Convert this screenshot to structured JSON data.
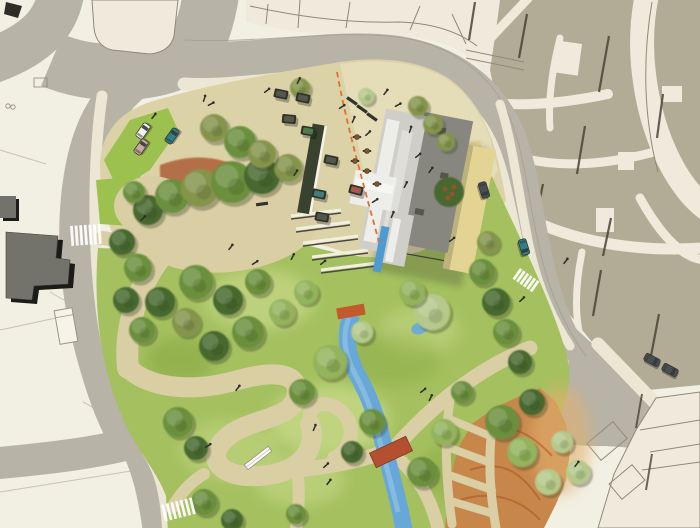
{
  "palette": {
    "background": "#f2efe3",
    "parcel_line": "#c9c3b0",
    "block": "#b2ab96",
    "block_edge": "#4a4436",
    "block_line": "#8f897a",
    "street_cream": "#efeadb",
    "road": "#b7b3a6",
    "road_edge": "#a09c8e",
    "sidewalk": "#ece7d4",
    "plaza": "#dcd2a8",
    "plaza_light": "#e6debb",
    "courtyard": "#e3d494",
    "lawn": "#a4c05f",
    "lawn_bright": "#9dc14e",
    "lawn_light": "#c7d987",
    "lawn_dark": "#84a43c",
    "path": "#d9cea4",
    "mulch": "#ad6038",
    "slope": "#c8874a",
    "slope_streak": "#a85a28",
    "slope_light": "#e2b070",
    "water": "#68a8d8",
    "water_light": "#93c3e6",
    "pool": "#4e9bd2",
    "bridge": "#b4502f",
    "fountain": "#c35a2c",
    "dashed_line": "#e0702c",
    "roof_light": "#cfcec8",
    "roof_white": "#ededea",
    "roof_mid": "#dfdeda",
    "wing_dark": "#87877f",
    "roof_detail": "#55554e",
    "strip_dark": "#39422e",
    "strip_edge": "#f5f3ea",
    "bench_body": "#2f332a",
    "bench_top_dark": "#54584a",
    "bench_green": "#4c7c4a",
    "bench_red": "#b2544a",
    "bench_teal": "#3f7e7b",
    "car_white": "#f2f2ee",
    "car_teal": "#2e7f86",
    "car_dark": "#4a4f52",
    "car_pink": "#c9a8a0",
    "people": "#2f2e28",
    "table_brown": "#7a5632",
    "white_bench": "#fafaf6",
    "dark_building": "#73736c",
    "crosswalk": "#ffffff",
    "tree": {
      "shadow": "#3a4526",
      "dark": "#47682e",
      "mid": "#6b8f3d",
      "olive": "#85944c",
      "light": "#93b35c",
      "pale": "#b5c98b"
    }
  },
  "features": {
    "trees": [
      {
        "x": 148,
        "y": 210,
        "r": 15,
        "tone": "dark"
      },
      {
        "x": 172,
        "y": 196,
        "r": 17,
        "tone": "mid"
      },
      {
        "x": 200,
        "y": 188,
        "r": 19,
        "tone": "olive"
      },
      {
        "x": 232,
        "y": 182,
        "r": 21,
        "tone": "mid"
      },
      {
        "x": 262,
        "y": 176,
        "r": 18,
        "tone": "dark"
      },
      {
        "x": 288,
        "y": 168,
        "r": 14,
        "tone": "olive"
      },
      {
        "x": 214,
        "y": 128,
        "r": 14,
        "tone": "olive"
      },
      {
        "x": 240,
        "y": 142,
        "r": 16,
        "tone": "mid"
      },
      {
        "x": 262,
        "y": 154,
        "r": 14,
        "tone": "olive"
      },
      {
        "x": 122,
        "y": 242,
        "r": 13,
        "tone": "dark"
      },
      {
        "x": 138,
        "y": 268,
        "r": 14,
        "tone": "mid"
      },
      {
        "x": 126,
        "y": 300,
        "r": 13,
        "tone": "dark"
      },
      {
        "x": 142,
        "y": 330,
        "r": 13,
        "tone": "mid"
      },
      {
        "x": 160,
        "y": 302,
        "r": 15,
        "tone": "dark"
      },
      {
        "x": 196,
        "y": 282,
        "r": 17,
        "tone": "mid"
      },
      {
        "x": 228,
        "y": 300,
        "r": 15,
        "tone": "dark"
      },
      {
        "x": 258,
        "y": 282,
        "r": 13,
        "tone": "mid"
      },
      {
        "x": 186,
        "y": 322,
        "r": 14,
        "tone": "olive"
      },
      {
        "x": 214,
        "y": 346,
        "r": 15,
        "tone": "dark"
      },
      {
        "x": 248,
        "y": 332,
        "r": 16,
        "tone": "mid"
      },
      {
        "x": 282,
        "y": 312,
        "r": 13,
        "tone": "light"
      },
      {
        "x": 306,
        "y": 292,
        "r": 12,
        "tone": "light"
      },
      {
        "x": 330,
        "y": 362,
        "r": 17,
        "tone": "light"
      },
      {
        "x": 302,
        "y": 392,
        "r": 13,
        "tone": "mid"
      },
      {
        "x": 362,
        "y": 332,
        "r": 11,
        "tone": "pale"
      },
      {
        "x": 432,
        "y": 312,
        "r": 18,
        "tone": "pale"
      },
      {
        "x": 412,
        "y": 292,
        "r": 13,
        "tone": "light"
      },
      {
        "x": 372,
        "y": 422,
        "r": 13,
        "tone": "mid"
      },
      {
        "x": 352,
        "y": 452,
        "r": 11,
        "tone": "dark"
      },
      {
        "x": 422,
        "y": 472,
        "r": 15,
        "tone": "mid"
      },
      {
        "x": 444,
        "y": 432,
        "r": 13,
        "tone": "light"
      },
      {
        "x": 462,
        "y": 392,
        "r": 11,
        "tone": "mid"
      },
      {
        "x": 482,
        "y": 272,
        "r": 13,
        "tone": "mid"
      },
      {
        "x": 496,
        "y": 302,
        "r": 14,
        "tone": "dark"
      },
      {
        "x": 506,
        "y": 332,
        "r": 13,
        "tone": "mid"
      },
      {
        "x": 520,
        "y": 362,
        "r": 12,
        "tone": "dark"
      },
      {
        "x": 488,
        "y": 242,
        "r": 11,
        "tone": "olive"
      },
      {
        "x": 502,
        "y": 422,
        "r": 17,
        "tone": "mid"
      },
      {
        "x": 522,
        "y": 452,
        "r": 15,
        "tone": "light"
      },
      {
        "x": 548,
        "y": 482,
        "r": 13,
        "tone": "pale"
      },
      {
        "x": 562,
        "y": 442,
        "r": 11,
        "tone": "pale"
      },
      {
        "x": 578,
        "y": 472,
        "r": 12,
        "tone": "pale"
      },
      {
        "x": 532,
        "y": 402,
        "r": 13,
        "tone": "dark"
      },
      {
        "x": 178,
        "y": 422,
        "r": 15,
        "tone": "mid"
      },
      {
        "x": 196,
        "y": 448,
        "r": 12,
        "tone": "dark"
      },
      {
        "x": 204,
        "y": 502,
        "r": 13,
        "tone": "mid"
      },
      {
        "x": 232,
        "y": 520,
        "r": 11,
        "tone": "dark"
      },
      {
        "x": 296,
        "y": 514,
        "r": 10,
        "tone": "mid"
      },
      {
        "x": 300,
        "y": 88,
        "r": 10,
        "tone": "olive"
      },
      {
        "x": 418,
        "y": 106,
        "r": 10,
        "tone": "olive"
      },
      {
        "x": 433,
        "y": 124,
        "r": 10,
        "tone": "olive"
      },
      {
        "x": 446,
        "y": 142,
        "r": 9,
        "tone": "olive"
      },
      {
        "x": 366,
        "y": 96,
        "r": 8,
        "tone": "pale"
      },
      {
        "x": 134,
        "y": 192,
        "r": 11,
        "tone": "mid"
      }
    ],
    "people": [
      {
        "x": 203,
        "y": 100,
        "a": -20
      },
      {
        "x": 209,
        "y": 104,
        "a": 25
      },
      {
        "x": 152,
        "y": 117,
        "a": 0
      },
      {
        "x": 265,
        "y": 91,
        "a": 15
      },
      {
        "x": 297,
        "y": 82,
        "a": -10
      },
      {
        "x": 340,
        "y": 107,
        "a": 20
      },
      {
        "x": 352,
        "y": 121,
        "a": -15
      },
      {
        "x": 366,
        "y": 134,
        "a": 10
      },
      {
        "x": 384,
        "y": 93,
        "a": 0
      },
      {
        "x": 396,
        "y": 105,
        "a": 25
      },
      {
        "x": 409,
        "y": 131,
        "a": -20
      },
      {
        "x": 416,
        "y": 156,
        "a": 15
      },
      {
        "x": 429,
        "y": 171,
        "a": 0
      },
      {
        "x": 373,
        "y": 201,
        "a": 20
      },
      {
        "x": 391,
        "y": 216,
        "a": -15
      },
      {
        "x": 141,
        "y": 219,
        "a": 10
      },
      {
        "x": 229,
        "y": 248,
        "a": 0
      },
      {
        "x": 253,
        "y": 263,
        "a": 20
      },
      {
        "x": 291,
        "y": 258,
        "a": -10
      },
      {
        "x": 321,
        "y": 263,
        "a": 15
      },
      {
        "x": 236,
        "y": 389,
        "a": 0
      },
      {
        "x": 206,
        "y": 446,
        "a": 20
      },
      {
        "x": 313,
        "y": 429,
        "a": -15
      },
      {
        "x": 324,
        "y": 466,
        "a": 10
      },
      {
        "x": 327,
        "y": 483,
        "a": 0
      },
      {
        "x": 421,
        "y": 391,
        "a": 15
      },
      {
        "x": 429,
        "y": 399,
        "a": -10
      },
      {
        "x": 564,
        "y": 262,
        "a": 0
      },
      {
        "x": 520,
        "y": 300,
        "a": 10
      },
      {
        "x": 575,
        "y": 465,
        "a": 0
      },
      {
        "x": 450,
        "y": 240,
        "a": 15
      },
      {
        "x": 404,
        "y": 186,
        "a": -10
      },
      {
        "x": 294,
        "y": 174,
        "a": -5
      }
    ],
    "cars": [
      {
        "x": 143,
        "y": 131,
        "a": -55,
        "tone": "white"
      },
      {
        "x": 141,
        "y": 147,
        "a": -55,
        "tone": "pink"
      },
      {
        "x": 172,
        "y": 136,
        "a": -55,
        "tone": "teal"
      },
      {
        "x": 484,
        "y": 190,
        "a": 73,
        "tone": "dark"
      },
      {
        "x": 524,
        "y": 247,
        "a": 73,
        "tone": "teal"
      },
      {
        "x": 652,
        "y": 360,
        "a": 28,
        "tone": "dark"
      },
      {
        "x": 670,
        "y": 370,
        "a": 28,
        "tone": "dark"
      }
    ],
    "benches": [
      {
        "x": 281,
        "y": 94,
        "a": 12,
        "top": "dark",
        "kind": "table"
      },
      {
        "x": 303,
        "y": 98,
        "a": 12,
        "top": "dark",
        "kind": "table"
      },
      {
        "x": 308,
        "y": 131,
        "a": 10,
        "top": "green",
        "kind": "table"
      },
      {
        "x": 331,
        "y": 160,
        "a": 12,
        "top": "dark",
        "kind": "table"
      },
      {
        "x": 319,
        "y": 194,
        "a": 12,
        "top": "teal",
        "kind": "table"
      },
      {
        "x": 356,
        "y": 190,
        "a": 14,
        "top": "red",
        "kind": "table"
      },
      {
        "x": 322,
        "y": 217,
        "a": 10,
        "top": "dark",
        "kind": "table"
      },
      {
        "x": 289,
        "y": 119,
        "a": 5,
        "top": "dark",
        "kind": "table"
      },
      {
        "x": 352,
        "y": 101,
        "a": 35,
        "kind": "bar"
      },
      {
        "x": 362,
        "y": 109,
        "a": 35,
        "kind": "bar"
      },
      {
        "x": 372,
        "y": 117,
        "a": 35,
        "kind": "bar"
      },
      {
        "x": 262,
        "y": 204,
        "a": -8,
        "kind": "bar"
      }
    ],
    "tables": [
      {
        "x": 357,
        "y": 137
      },
      {
        "x": 367,
        "y": 151
      },
      {
        "x": 355,
        "y": 161
      },
      {
        "x": 367,
        "y": 171
      },
      {
        "x": 377,
        "y": 184
      }
    ],
    "crosswalks": [
      {
        "x": 70,
        "y": 226,
        "a": -4,
        "bars": 7,
        "h": 20,
        "gap": 4.6
      },
      {
        "x": 161,
        "y": 505,
        "a": -14,
        "bars": 7,
        "h": 17,
        "gap": 4.8
      },
      {
        "x": 520,
        "y": 268,
        "a": 35,
        "bars": 6,
        "h": 13,
        "gap": 4.2
      }
    ]
  }
}
